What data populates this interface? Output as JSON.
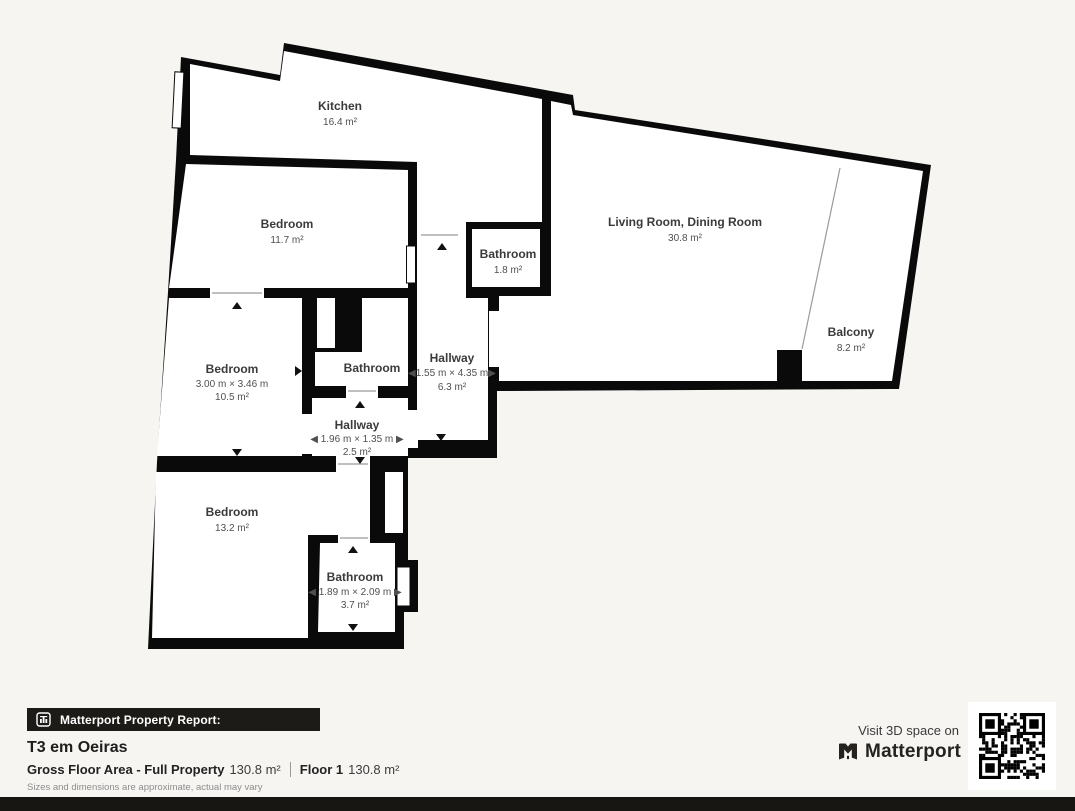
{
  "colors": {
    "background": "#f6f5f2",
    "wall": "#0a0a0a",
    "room_fill": "#ffffff",
    "bar_background": "#1d1b18",
    "label_text": "#3b3b3b"
  },
  "rooms": {
    "kitchen": {
      "name": "Kitchen",
      "area": "16.4 m²"
    },
    "living": {
      "name": "Living Room, Dining Room",
      "area": "30.8 m²"
    },
    "balcony": {
      "name": "Balcony",
      "area": "8.2 m²"
    },
    "bedroom_top": {
      "name": "Bedroom",
      "area": "11.7 m²"
    },
    "bedroom_mid": {
      "name": "Bedroom",
      "dims": "3.00 m × 3.46 m",
      "area": "10.5 m²"
    },
    "bedroom_bottom": {
      "name": "Bedroom",
      "area": "13.2 m²"
    },
    "bathroom_top": {
      "name": "Bathroom",
      "area": "1.8 m²"
    },
    "bathroom_mid": {
      "name": "Bathroom"
    },
    "bathroom_bottom": {
      "name": "Bathroom",
      "dims": "◀ 1.89 m × 2.09 m ▶",
      "area": "3.7 m²"
    },
    "hallway_main": {
      "name": "Hallway",
      "dims": "◀1.55 m × 4.35 m▶",
      "area": "6.3 m²"
    },
    "hallway_small": {
      "name": "Hallway",
      "dims": "◀ 1.96 m × 1.35 m ▶",
      "area": "2.5 m²"
    }
  },
  "footer": {
    "report_label": "Matterport Property Report:",
    "property_title": "T3 em Oeiras",
    "gfa_label": "Gross Floor Area - Full Property",
    "gfa_value": "130.8 m²",
    "floor_label": "Floor 1",
    "floor_value": "130.8 m²",
    "disclaimer": "Sizes and dimensions are approximate, actual may vary",
    "visit_text": "Visit 3D space on",
    "brand_name": "Matterport"
  }
}
